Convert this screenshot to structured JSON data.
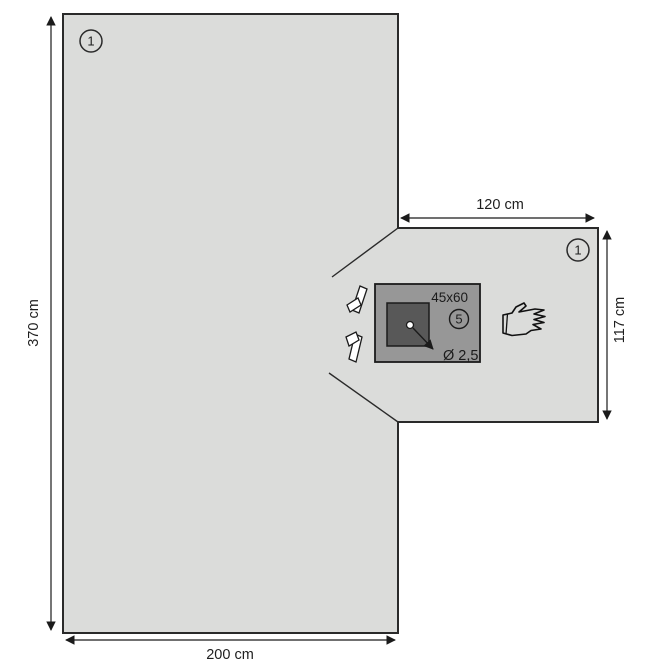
{
  "diagram": {
    "type": "surgical-drape-technical-drawing",
    "labels": {
      "sheet_marker": "1",
      "panel_marker": "1",
      "film_size": "45x60",
      "film_marker": "5",
      "hole_diameter": "Ø 2,5"
    },
    "dimensions": {
      "sheet_height": "370 cm",
      "sheet_width": "200 cm",
      "panel_width": "120 cm",
      "panel_height": "117 cm"
    },
    "colors": {
      "background": "#ffffff",
      "sheet_fill": "#dbdcda",
      "film_fill": "#979797",
      "aperture_fill": "#585858",
      "line": "#2a2a2a"
    },
    "icons": {
      "hand": "hand-icon",
      "tape_tab_top": "tape-tab-icon",
      "tape_tab_bottom": "tape-tab-icon"
    }
  }
}
